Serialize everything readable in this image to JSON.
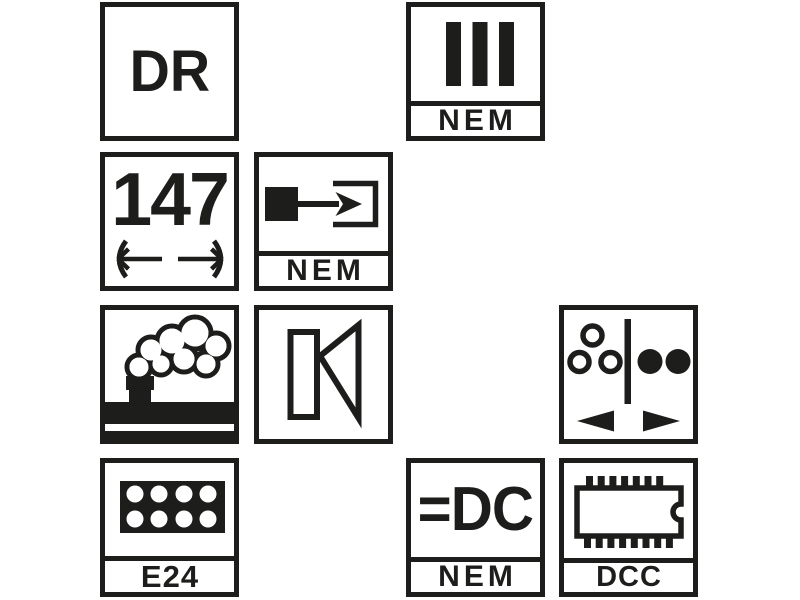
{
  "palette": {
    "ink": "#1d1d1b",
    "paper": "#ffffff"
  },
  "pictograms": {
    "railway_company": {
      "label": "DR"
    },
    "era": {
      "numeral": "III",
      "standard": "NEM"
    },
    "length_over_buffers": {
      "value": "147"
    },
    "coupler_pocket": {
      "standard": "NEM"
    },
    "power_system": {
      "value": "=DC",
      "standard": "NEM"
    },
    "electrical_interface": {
      "label": "E24"
    },
    "decoder": {
      "label": "DCC"
    }
  },
  "icons": {
    "era": "epoch-three-bars-icon",
    "length": "buffer-length-arrows-icon",
    "coupler": "coupler-pocket-arrow-icon",
    "smoke": "smoke-generator-icon",
    "sound": "speaker-icon",
    "lighting": "directional-lighting-change-icon",
    "interface": "e24-socket-icon",
    "decoder": "dcc-chip-icon"
  }
}
